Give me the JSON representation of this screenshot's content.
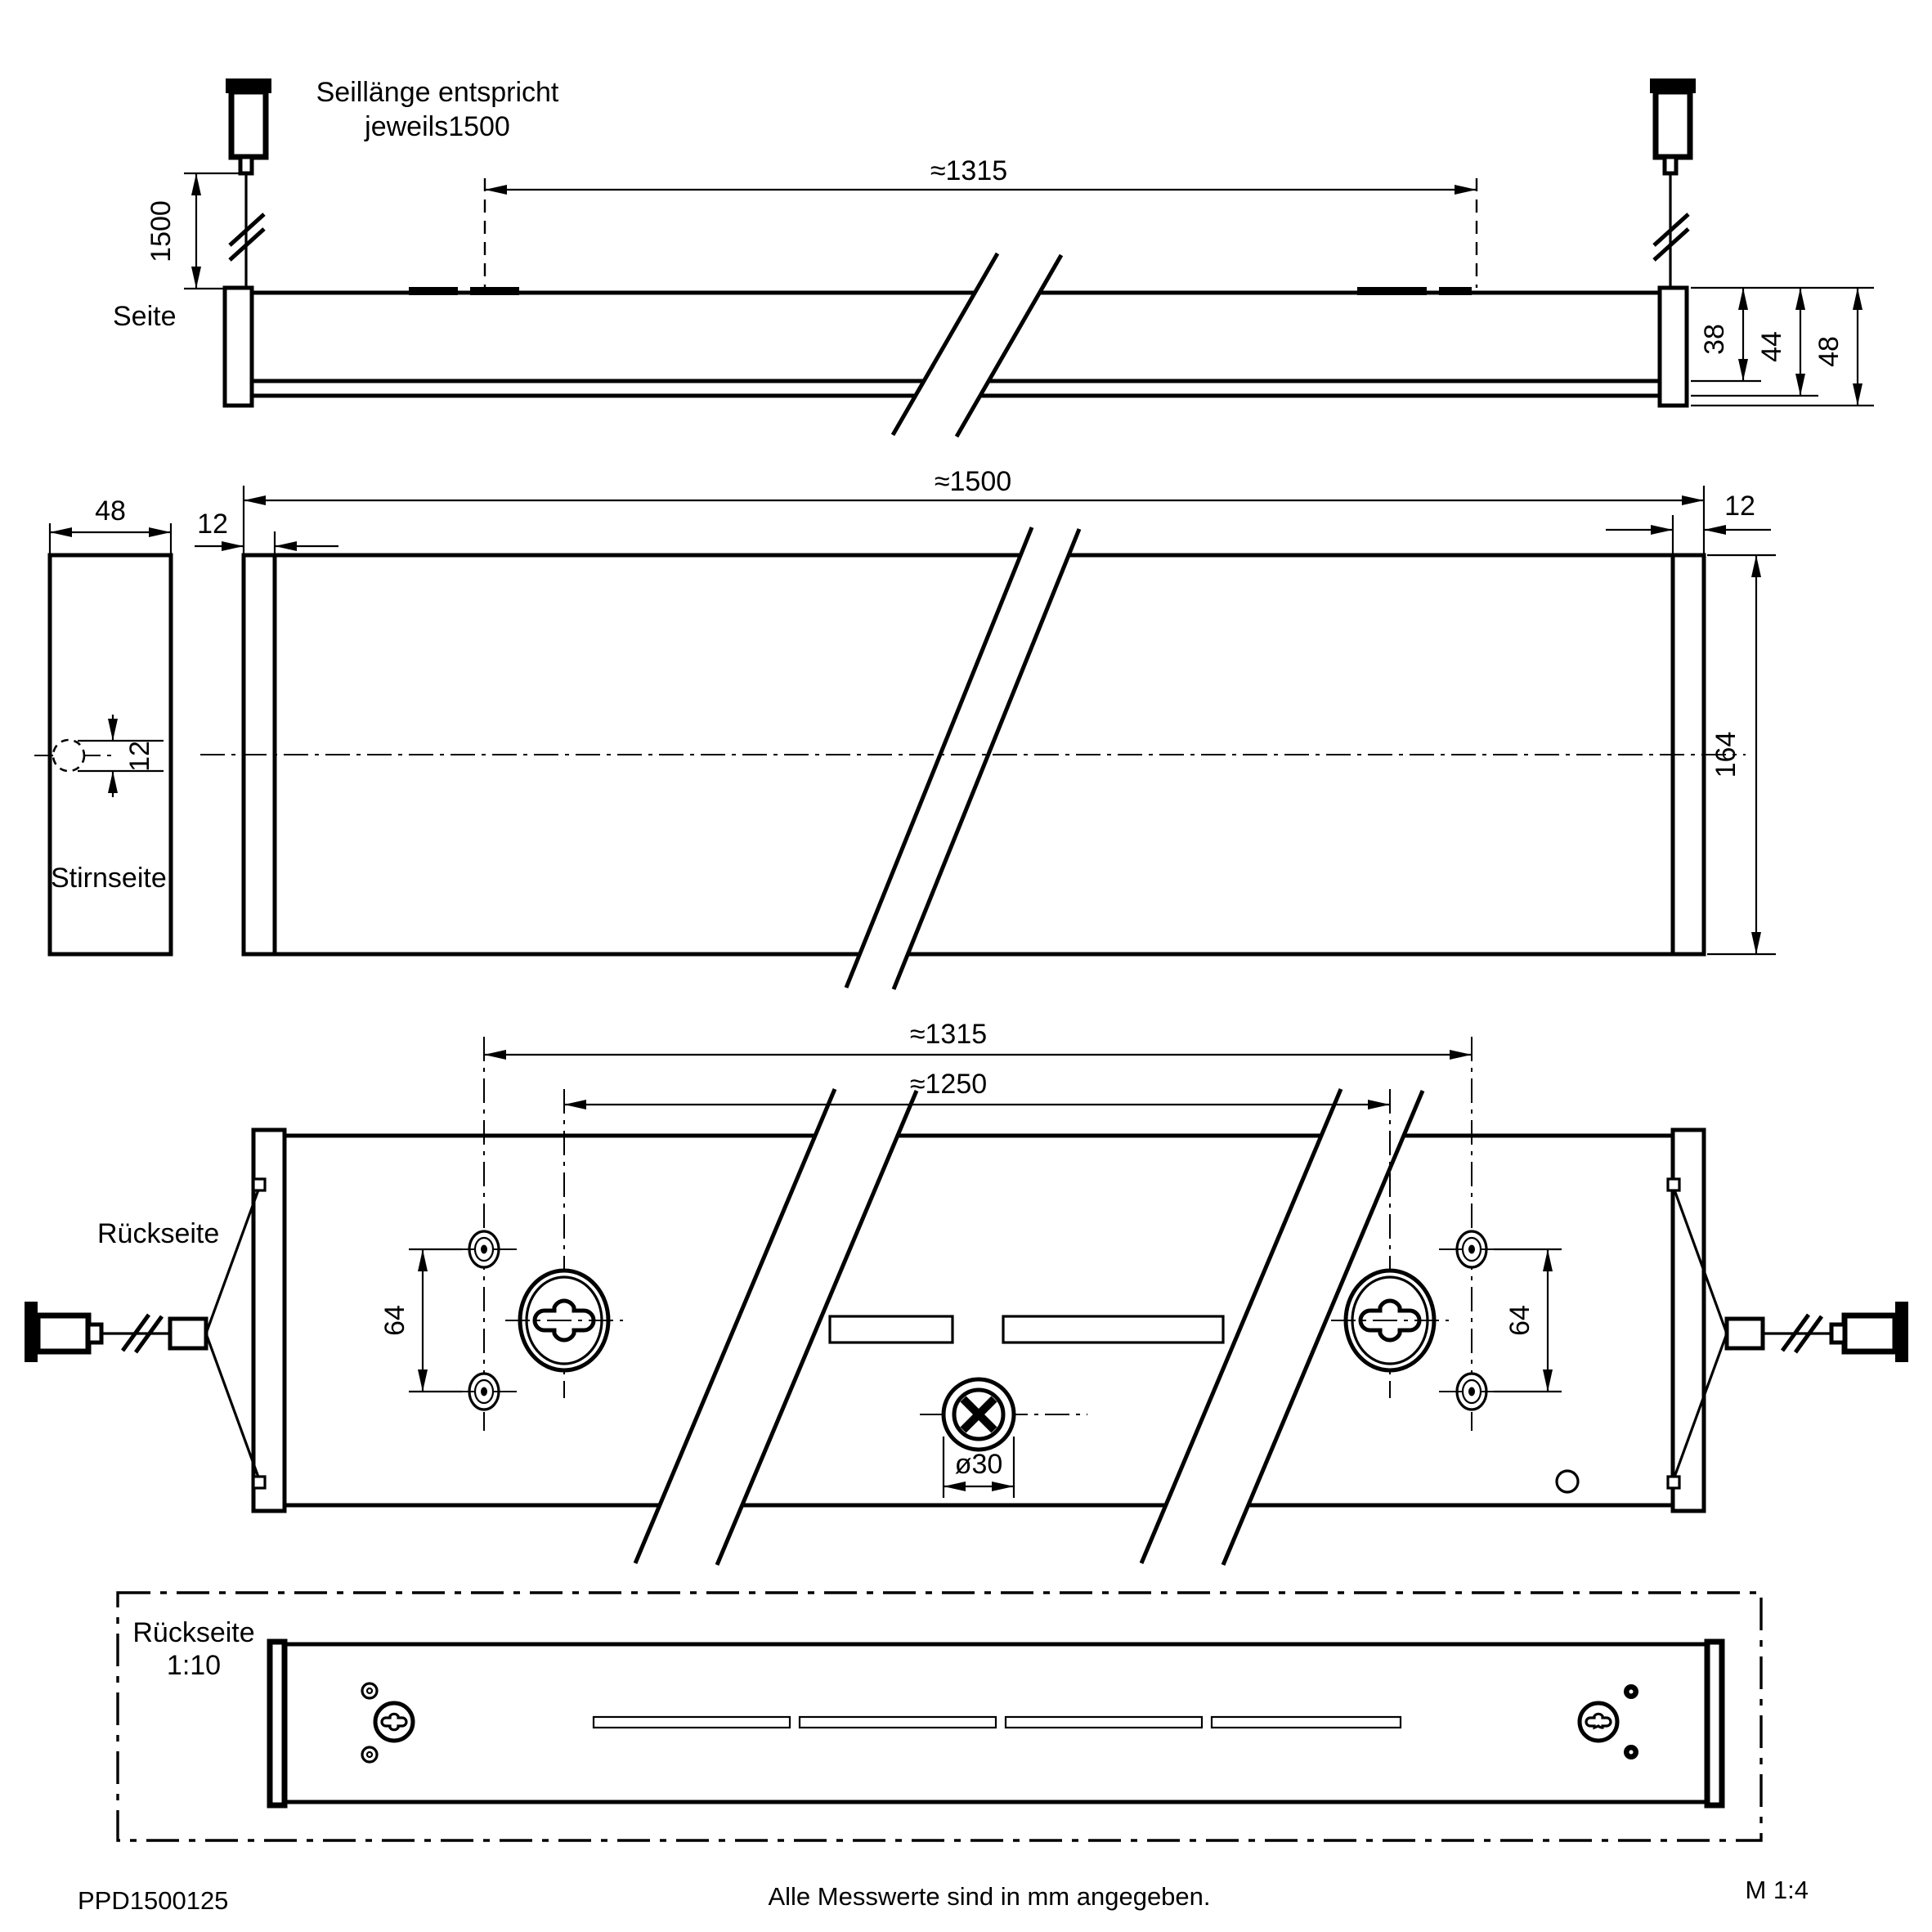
{
  "labels": {
    "side_view": "Seite",
    "front_view": "Stirnseite",
    "back_view": "Rückseite",
    "back_small_line1": "Rückseite",
    "back_small_line2": "1:10"
  },
  "annotations": {
    "suspension_note_line1": "Seillänge entspricht",
    "suspension_note_line2": "jeweils1500"
  },
  "dimensions": {
    "side": {
      "cable_length": "1500",
      "suspension_spacing": "≈1315",
      "housing_height": "38",
      "with_diffuser_height": "44",
      "total_height": "48"
    },
    "front": {
      "width": "48",
      "cable_hole_diameter": "12"
    },
    "top": {
      "total_length": "≈1500",
      "left_end_cap": "12",
      "right_end_cap": "12",
      "fixture_width": "164"
    },
    "back": {
      "suspension_spacing": "≈1315",
      "keyhole_spacing": "≈1250",
      "left_hole_spacing": "64",
      "right_hole_spacing": "64",
      "cable_entry_diameter": "ø30"
    }
  },
  "footer": {
    "drawing_number": "PPD1500125",
    "note": "Alle Messwerte sind in mm angegeben.",
    "scale": "M 1:4"
  },
  "style": {
    "line_color": "#000000",
    "background": "#ffffff"
  }
}
